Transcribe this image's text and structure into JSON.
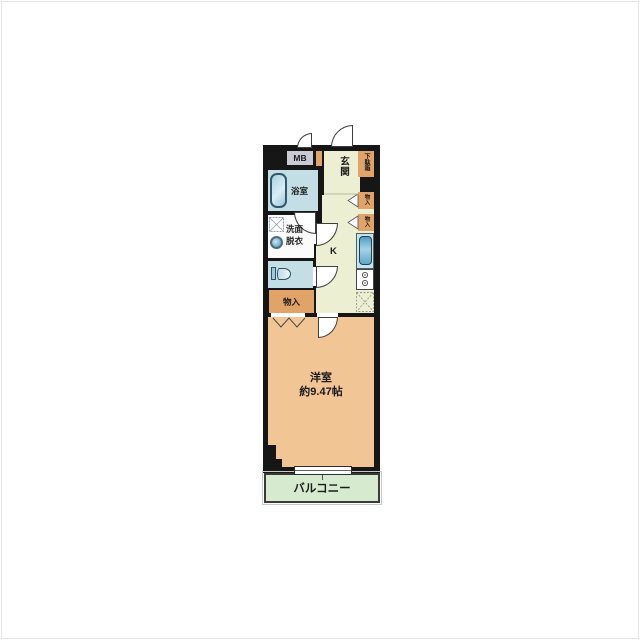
{
  "plan": {
    "meter_box": {
      "label": "MB"
    },
    "entrance": {
      "label": "玄関"
    },
    "shoe_cabinet": {
      "label": "下駄箱"
    },
    "bathroom": {
      "label": "浴室"
    },
    "washroom": {
      "line1": "洗面",
      "line2": "脱衣"
    },
    "storage": {
      "label": "物入"
    },
    "storage_right_top": {
      "label": "物入"
    },
    "storage_right_bottom": {
      "label": "物入"
    },
    "kitchen": {
      "label": "K"
    },
    "main_room": {
      "label": "洋室",
      "area": "約9.47帖"
    },
    "balcony": {
      "label": "バルコニー"
    },
    "colors": {
      "wall": "#161616",
      "entrance_hall_kitchen": "#edefd2",
      "bathroom_toilet": "#c3dee4",
      "storage_cabinet": "#e2a368",
      "main_room": "#f2c694",
      "balcony": "#d5eace",
      "meter_box": "#c9cad3"
    }
  }
}
